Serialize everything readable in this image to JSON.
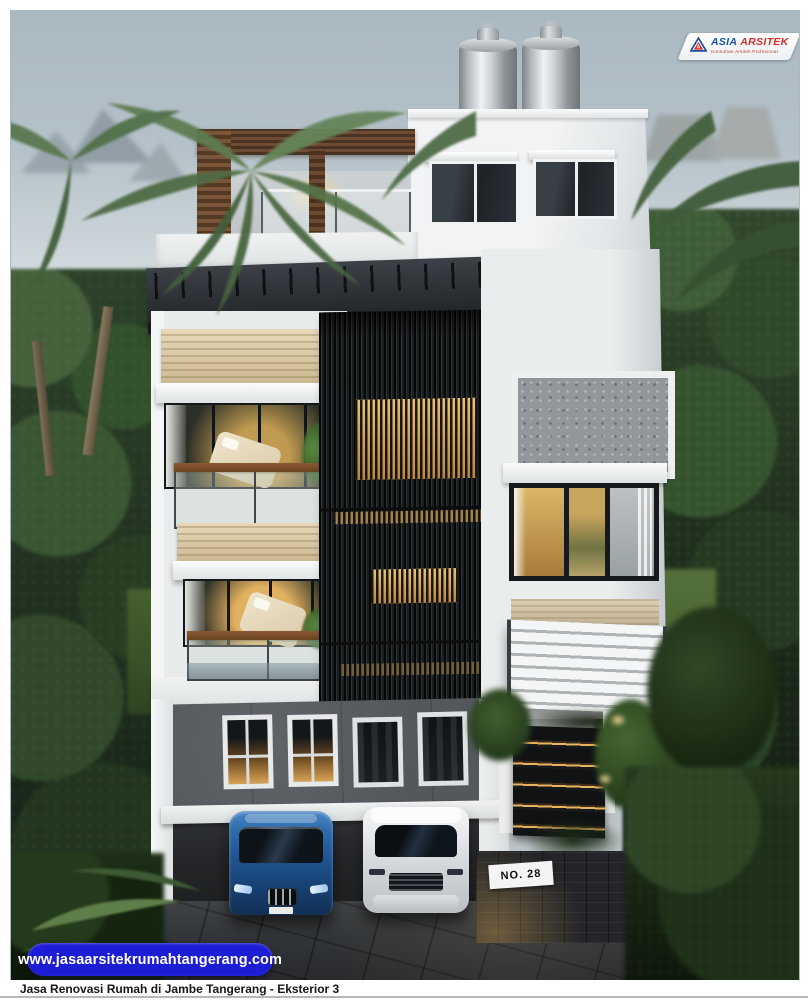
{
  "branding": {
    "logo": {
      "primary": "ASIA",
      "secondary": "ARSITEK",
      "tagline": "Konsultan Arsitek Profesional"
    },
    "website": "www.jasaarsitekrumahtangerang.com"
  },
  "caption": "Jasa Renovasi Rumah di Jambe Tangerang - Eksterior 3",
  "house_sign": "NO. 28",
  "colors": {
    "url_pill_bg": "#1d1dd6",
    "url_pill_text": "#ffffff",
    "logo_primary_blue": "#1b4f9e",
    "logo_secondary_red": "#d52b28",
    "caption_text": "#161616",
    "canopy_dark": "#2b2f34",
    "wood_accent": "#d8c8a6",
    "warm_light": "#e0b160"
  }
}
